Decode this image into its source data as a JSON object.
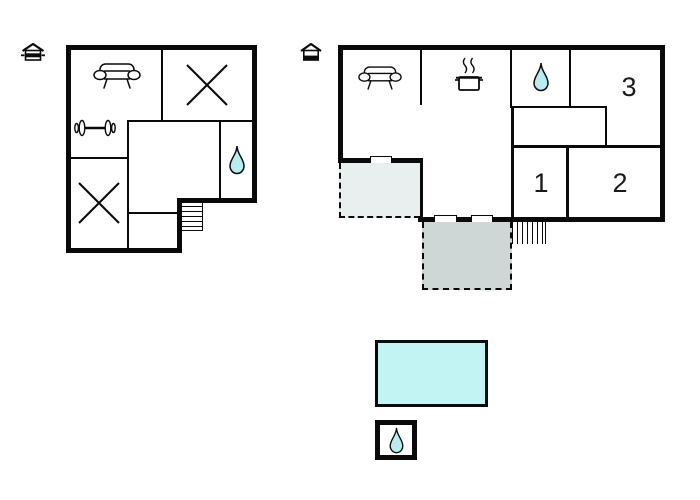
{
  "palette": {
    "wall": "#0a0a0a",
    "background": "#ffffff",
    "pool_fill": "#c2f4f4",
    "terrace_upper_fill": "#e9eeee",
    "terrace_lower_fill": "#ced6d6",
    "water_drop_fill": "#b9ecf0"
  },
  "plans": {
    "lower": {
      "level_icon": "house-lower-level-icon",
      "features": [
        "sofa-icon",
        "dumbbell-icon",
        "room-x-icon",
        "room-x-icon",
        "water-drop-icon",
        "stairs"
      ]
    },
    "upper": {
      "level_icon": "house-upper-level-icon",
      "room_labels": {
        "room1": "1",
        "room2": "2",
        "room3": "3"
      },
      "features": [
        "sofa-icon",
        "cooking-pot-icon",
        "water-drop-icon",
        "stairs",
        "terrace-upper",
        "terrace-lower"
      ]
    }
  },
  "outdoor": {
    "pool": "pool",
    "wellness_box": "water-drop-box"
  }
}
